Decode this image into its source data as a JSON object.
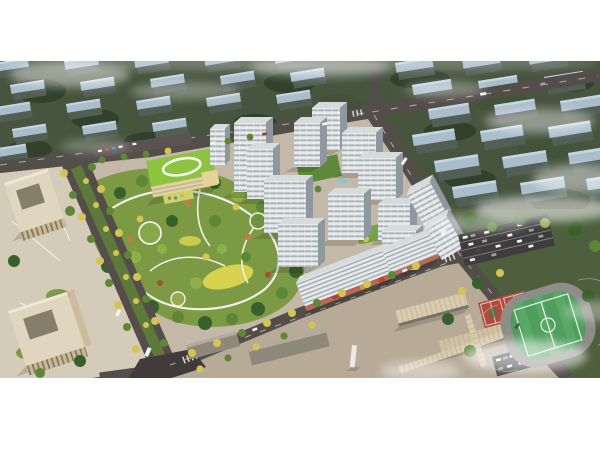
{
  "palette": {
    "page_bg": "#ffffff",
    "backdrop_green": "#47553f",
    "backdrop_roof": "#a9bdcb",
    "backdrop_roof_lit": "#c6d6e0",
    "backdrop_wall": "#525f55",
    "backdrop_tree_dark": "#32412c",
    "backdrop_tree_mid": "#42533a",
    "road_asphalt": "#544e4a",
    "road_dark": "#413c3b",
    "road_line": "#cfcabf",
    "boulevard_median": "#5e7a3a",
    "pavement": "#c4b9a8",
    "plaza": "#d5cbb9",
    "park_base": "#7c9a43",
    "park_lawn_yellow": "#d6d44e",
    "path_white": "#f0efe9",
    "tree_bright": "#8fb049",
    "tree_green": "#5d8636",
    "tree_dark": "#38602a",
    "tree_autumn": "#d3c455",
    "tree_orange": "#bf7e41",
    "tree_red": "#a65136",
    "tower_front": "#e7eaea",
    "tower_side": "#8f989e",
    "tower_roof": "#d6dbdc",
    "tower_window": "#97a2a8",
    "retail_accent": "#b5543d",
    "kindergarten_roof": "#8cc43f",
    "kindergarten_wall": "#e6d29a",
    "office_roof": "#e0d6bf",
    "office_wall": "#c9b894",
    "school_roof": "#d8cbae",
    "pitch_green": "#4f9e5e",
    "track_gray": "#8e8d88",
    "court_red": "#b34a3c",
    "car_white": "#f2f3f4",
    "pool_blue": "#7ec8d8"
  },
  "scene": {
    "type": "aerial-architectural-rendering",
    "elements": [
      {
        "name": "backdrop-housing-rows"
      },
      {
        "name": "fog-clouds"
      },
      {
        "name": "perimeter-roads"
      },
      {
        "name": "tree-lined-boulevard"
      },
      {
        "name": "central-park"
      },
      {
        "name": "kindergarten-green-roof"
      },
      {
        "name": "residential-towers"
      },
      {
        "name": "street-retail-podium"
      },
      {
        "name": "office-blocks"
      },
      {
        "name": "school-campus"
      },
      {
        "name": "football-pitch-running-track"
      },
      {
        "name": "basketball-courts"
      },
      {
        "name": "parking-lots"
      },
      {
        "name": "street-trees"
      },
      {
        "name": "vehicles"
      }
    ]
  }
}
